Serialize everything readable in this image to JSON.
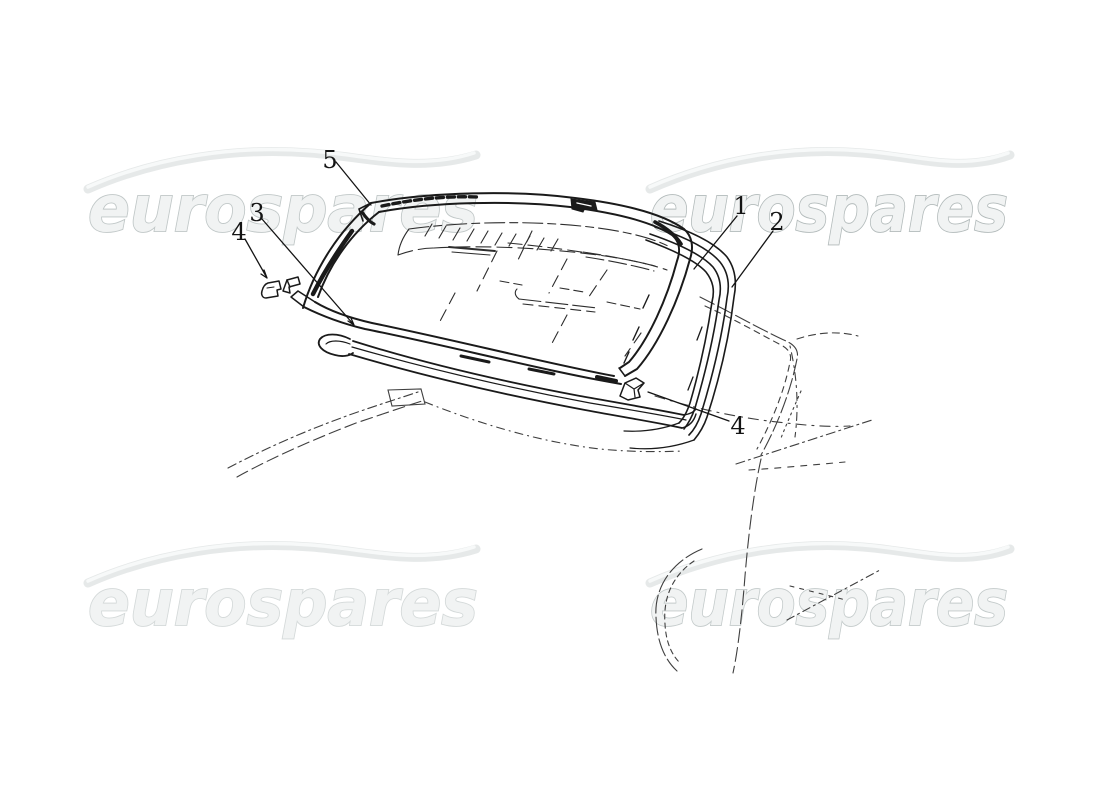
{
  "watermark": {
    "text": "eurospares",
    "text_fill": "#f1f3f3",
    "stroke_top_left": "#c0c7c7",
    "stroke_top_right": "#b2baba",
    "stroke_bottom_left": "#d4d9d9",
    "stroke_bottom_right": "#c3caca",
    "swoosh_color": "#e6e9e9",
    "swoosh_highlight": "#f7f9f9"
  },
  "callouts": [
    {
      "label": "5"
    },
    {
      "label": "3"
    },
    {
      "label": "4"
    },
    {
      "label": "1"
    },
    {
      "label": "2"
    },
    {
      "label": "4"
    }
  ],
  "diagram": {
    "ink": "#1a1a1a",
    "sketch_ink": "#3f3f3f",
    "background": "#ffffff"
  }
}
